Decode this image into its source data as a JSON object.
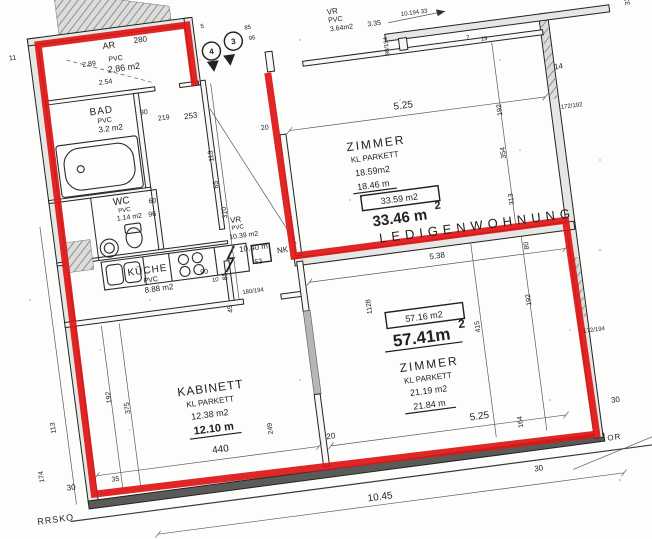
{
  "boundary_color": "#df1518",
  "rooms": {
    "ar": {
      "name": "AR",
      "dim": "280",
      "sub": "2.89",
      "floor": "PVC",
      "area": "2.86 m2",
      "dim2": "2.54"
    },
    "bad": {
      "name": "BAD",
      "floor": "PVC",
      "area": "3.2 m2",
      "d1": "90",
      "d2": "219"
    },
    "wc": {
      "name": "WC",
      "floor": "PVC",
      "area": "1.14 m2",
      "d1": "60",
      "d2": "96"
    },
    "kueche": {
      "name": "KÜCHE",
      "floor": "PVC",
      "area": "8.88 m2",
      "d1": "90",
      "d2": "10",
      "d3": "85",
      "d4": "45"
    },
    "vr_top": {
      "name": "VR",
      "floor": "PVC",
      "area": "3.64m2",
      "d1": "3.35",
      "d2": "80/194",
      "d3": "85",
      "d4": "95",
      "d5": "5"
    },
    "vr": {
      "name": "VR",
      "floor": "PVC",
      "area": "10.39 m2",
      "len": "10.40 m",
      "d1": "53",
      "d2": "253",
      "d3": "113",
      "d4": "65",
      "d5": "310",
      "d6": "20"
    },
    "zimmer_ob": {
      "name": "ZIMMER",
      "floor": "KL PARKETT",
      "area": "18.59m2",
      "len": "18.46 m",
      "boxed": "33.59 m2",
      "total": "33.46 m",
      "sup": "2",
      "d_top": "5.25",
      "d1": "192",
      "d2": "354",
      "d3": "313",
      "d4": "7",
      "d5": "19"
    },
    "zimmer_un": {
      "name": "ZIMMER",
      "floor": "KL PARKETT",
      "area": "21.19 m2",
      "len": "21.84 m",
      "boxed": "57.16 m2",
      "total": "57.41m",
      "sup": "2",
      "d_top": "5.38",
      "d_bot": "5.25",
      "d1": "80",
      "d2": "1128",
      "d3": "415",
      "d4": "192",
      "d5": "164"
    },
    "kabinett": {
      "name": "KABINETT",
      "floor": "KL PARKETT",
      "area": "12.38 m2",
      "len": "12.10 m",
      "d_bot": "440",
      "d1": "375",
      "d2": "192",
      "d3": "35",
      "d4": "20",
      "d5": "249"
    }
  },
  "annotations": {
    "ledigenwohnung": "LEDIGENWOHNUNG",
    "nk": "NK",
    "nk_dim": "180/194",
    "circle_1": "4",
    "circle_2": "3",
    "top_arrow": "10.194 33"
  },
  "exterior": {
    "left_11": "11",
    "left_113": "113",
    "left_174": "174",
    "left_30": "30",
    "rrsko": "RRSKO",
    "bottom_1045": "10.45",
    "bottom_30": "30",
    "right_14": "14",
    "right_172_192": "172/192",
    "right_172_194": "172/194",
    "right_30": "30",
    "right_or": "OR",
    "right_33": "33"
  }
}
